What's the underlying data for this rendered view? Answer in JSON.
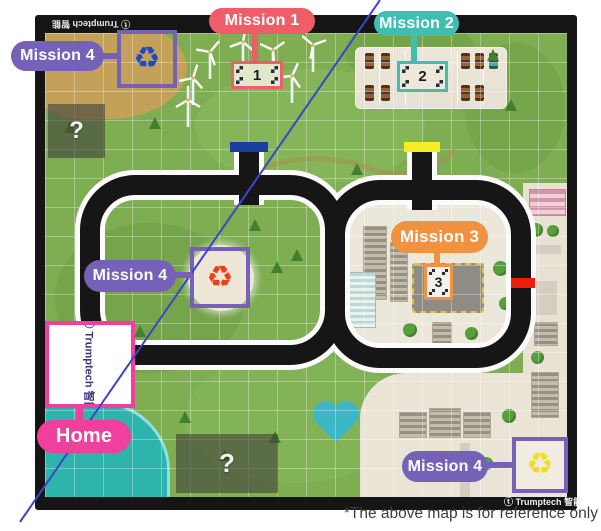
{
  "branding": {
    "icon": "ⓣ",
    "name": "Trumptech",
    "cjk": "智能"
  },
  "caption": "*The above map is for reference only",
  "missions": {
    "m1": {
      "label": "Mission 1",
      "number": "1",
      "color": "#ef5e68"
    },
    "m2": {
      "label": "Mission 2",
      "number": "2",
      "color": "#3fbfb2"
    },
    "m3": {
      "label": "Mission 3",
      "number": "3",
      "color": "#f0923f"
    },
    "m4": {
      "label": "Mission 4",
      "color": "#7561b8"
    }
  },
  "home": {
    "label": "Home",
    "color": "#f03f9d"
  },
  "markers": {
    "start_blue": "#1b3fa0",
    "start_yellow": "#f6ee25",
    "stop_red": "#ee1c0d"
  },
  "recycle": {
    "glyph": "♻",
    "blue": "#2346c8",
    "red": "#f53c12",
    "yellow": "#efe01a"
  },
  "unknown_zone": {
    "glyph": "?"
  },
  "reference_line_color": "#3a46c9"
}
